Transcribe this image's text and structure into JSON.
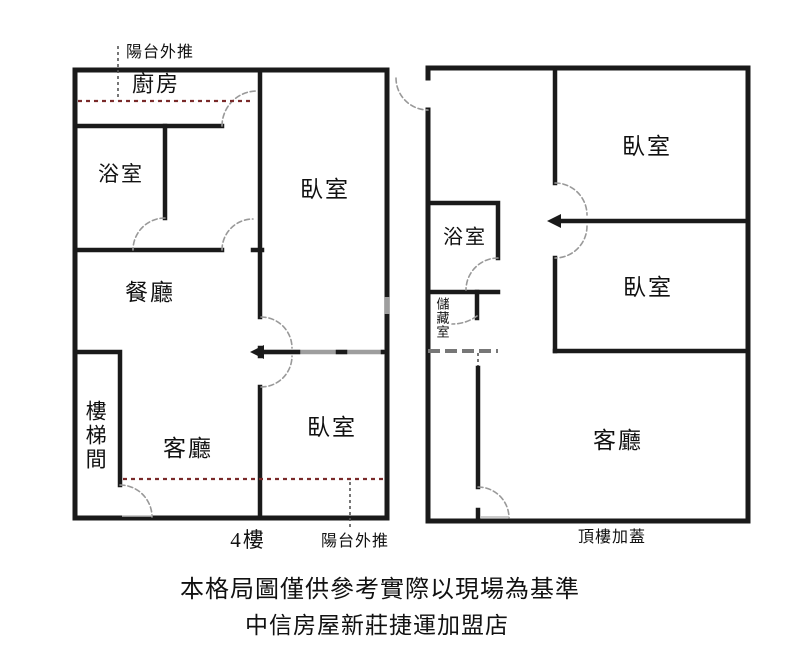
{
  "plans": {
    "left": {
      "floor_label": "4樓",
      "balcony_note_top": "陽台外推",
      "balcony_note_bottom": "陽台外推",
      "rooms": {
        "kitchen": "廚房",
        "bathroom": "浴室",
        "bedroom_upper": "臥室",
        "dining": "餐廳",
        "stairwell": "樓梯間",
        "living": "客廳",
        "bedroom_lower": "臥室"
      }
    },
    "right": {
      "floor_label": "頂樓加蓋",
      "rooms": {
        "bedroom_upper": "臥室",
        "bathroom": "浴室",
        "storage": "儲藏室",
        "bedroom_lower": "臥室",
        "living": "客廳"
      }
    }
  },
  "footer": {
    "disclaimer": "本格局圖僅供參考實際以現場為基準",
    "agency": "中信房屋新莊捷運加盟店"
  },
  "colors": {
    "wall": "#1a1a1a",
    "door_arc": "#999999",
    "balcony_dash": "#7a2a2a",
    "leader_dash": "#555555",
    "window": "#9e9e9e",
    "gray_wall": "#777777"
  }
}
